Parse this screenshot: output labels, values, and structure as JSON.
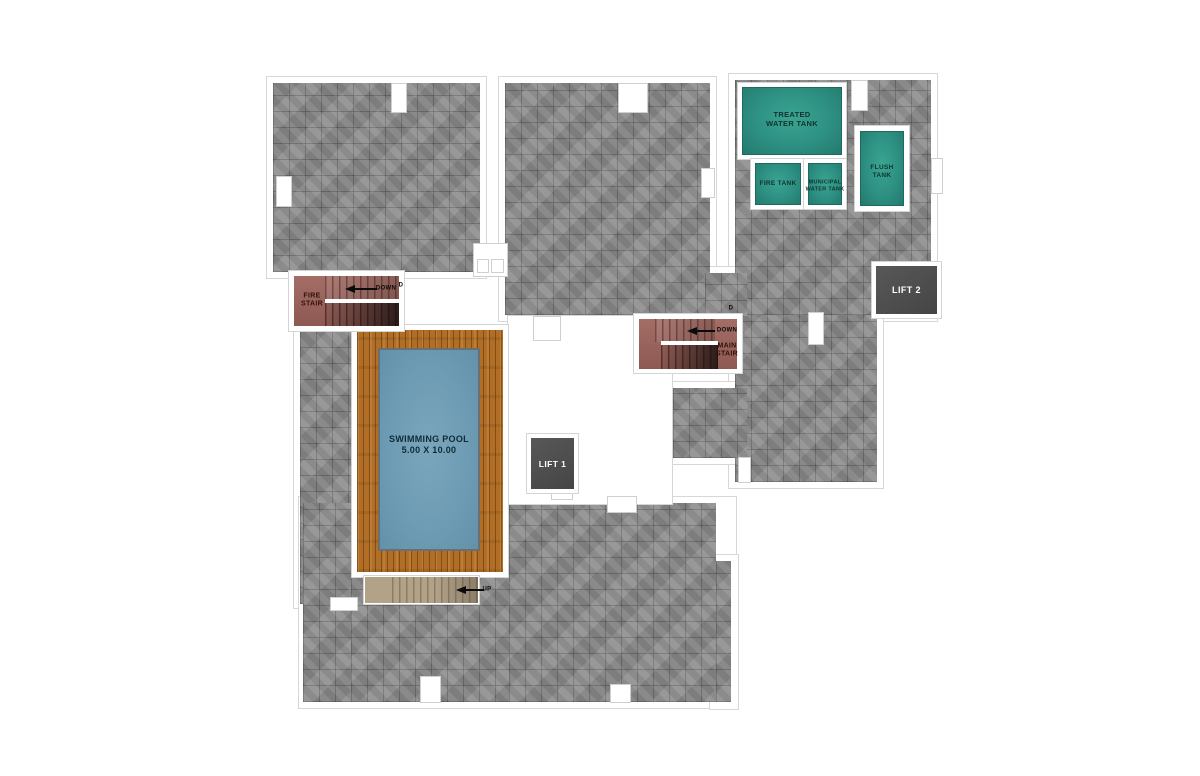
{
  "floor_plan": {
    "rooms": {
      "treated_water_tank": {
        "label_lines": [
          "TREATED",
          "WATER TANK"
        ]
      },
      "fire_tank": {
        "label": "FIRE TANK"
      },
      "municipal_water_tank": {
        "label_lines": [
          "MUNICIPAL",
          "WATER TANK"
        ]
      },
      "flush_tank": {
        "label_lines": [
          "FLUSH",
          "TANK"
        ]
      },
      "lift_1": {
        "label": "LIFT 1"
      },
      "lift_2": {
        "label": "LIFT 2"
      },
      "fire_stair": {
        "label_lines": [
          "FIRE",
          "STAIR"
        ],
        "direction": "DOWN",
        "door": "D"
      },
      "main_stair": {
        "label_lines": [
          "MAIN",
          "STAIR"
        ],
        "direction": "DOWN",
        "door": "D"
      },
      "swimming_pool": {
        "label": "SWIMMING POOL",
        "dimensions": "5.00 X 10.00"
      },
      "pool_stair": {
        "direction": "UP"
      }
    },
    "colors": {
      "floor_tile": "#8d8d8d",
      "tank_teal": "#2d9082",
      "stair_red": "#9d635b",
      "pool_blue": "#6d9bb3",
      "deck_wood": "#b06e27",
      "stair_tan": "#b2a288",
      "lift_dark": "#4e4e4e",
      "wall_white": "#ffffff"
    }
  }
}
